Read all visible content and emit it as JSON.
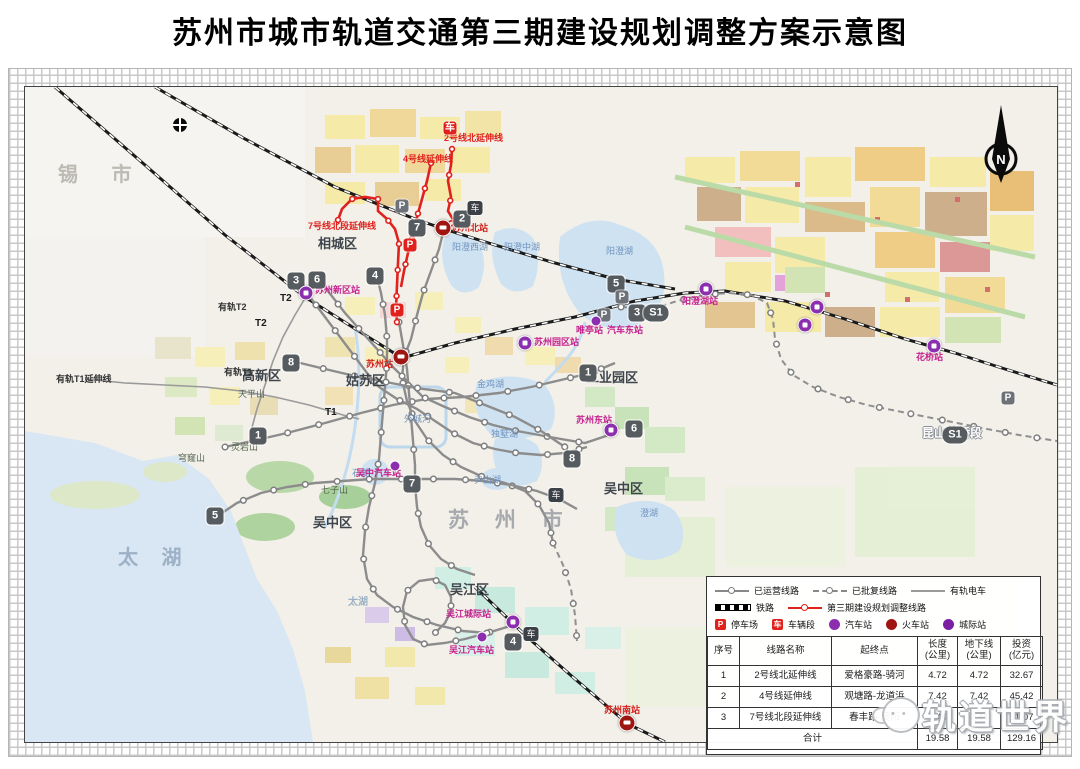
{
  "title": "苏州市城市轨道交通第三期建设规划调整方案示意图",
  "compass": {
    "n": "N"
  },
  "colors": {
    "planned_line": "#e0211c",
    "metro_line": "#8c8c8c",
    "intercity_station": "#8b2fae",
    "train_station": "#9e1512"
  },
  "icons": {
    "parking": "P",
    "depot_glyph": "车",
    "train_glyph": "车"
  },
  "map": {
    "labels": [
      {
        "t": "锡 市"
      },
      {
        "t": "相城区"
      },
      {
        "t": "姑苏区"
      },
      {
        "t": "高新区"
      },
      {
        "t": "工业园区"
      },
      {
        "t": "吴中区"
      },
      {
        "t": "吴中区"
      },
      {
        "t": "吴江区"
      },
      {
        "t": "苏 州 市"
      },
      {
        "t": "太 湖"
      },
      {
        "t": "太湖"
      },
      {
        "t": "昆山花桥段"
      },
      {
        "t": "阳澄西湖"
      },
      {
        "t": "阳澄中湖"
      },
      {
        "t": "阳澄湖"
      },
      {
        "t": "金鸡湖"
      },
      {
        "t": "独墅湖"
      },
      {
        "t": "澄湖"
      },
      {
        "t": "尹山湖"
      },
      {
        "t": "石湖"
      },
      {
        "t": "外城河"
      },
      {
        "t": "天平山"
      },
      {
        "t": "灵岩山"
      },
      {
        "t": "七子山"
      },
      {
        "t": "穹窿山"
      },
      {
        "t": "有轨T1"
      },
      {
        "t": "有轨T1延伸线"
      },
      {
        "t": "有轨T2"
      },
      {
        "t": "T2"
      },
      {
        "t": "T2"
      },
      {
        "t": "T1"
      },
      {
        "t": "2号线北延伸线"
      },
      {
        "t": "4号线延伸线"
      },
      {
        "t": "7号线北段延伸线"
      },
      {
        "t": "苏州北站"
      },
      {
        "t": "苏州站"
      },
      {
        "t": "苏州南站"
      },
      {
        "t": "苏州新区站"
      },
      {
        "t": "苏州园区站"
      },
      {
        "t": "吴江城际站"
      },
      {
        "t": "苏州东站"
      },
      {
        "t": "阳澄湖站"
      },
      {
        "t": "花桥站"
      },
      {
        "t": "汽车东站"
      },
      {
        "t": "吴江汽车站"
      },
      {
        "t": "吴中汽车站"
      },
      {
        "t": "唯亭站"
      }
    ],
    "badges": [
      {
        "t": "2"
      },
      {
        "t": "7"
      },
      {
        "t": "4"
      },
      {
        "t": "3"
      },
      {
        "t": "6"
      },
      {
        "t": "8"
      },
      {
        "t": "1"
      },
      {
        "t": "5"
      },
      {
        "t": "5"
      },
      {
        "t": "1"
      },
      {
        "t": "3"
      },
      {
        "t": "S1"
      },
      {
        "t": "6"
      },
      {
        "t": "8"
      },
      {
        "t": "7"
      },
      {
        "t": "4"
      },
      {
        "t": "S1"
      }
    ]
  },
  "legend": {
    "line_items": [
      {
        "label": "已运营线路"
      },
      {
        "label": "已批复线路"
      },
      {
        "label": "有轨电车"
      },
      {
        "label": "铁路"
      },
      {
        "label": "第三期建设规划调整线路"
      }
    ],
    "icon_items": [
      {
        "label": "停车场"
      },
      {
        "label": "车辆段"
      },
      {
        "label": "汽车站"
      },
      {
        "label": "火车站"
      },
      {
        "label": "城际站"
      }
    ]
  },
  "table": {
    "headers": [
      {
        "a": "序号",
        "b": ""
      },
      {
        "a": "线路名称",
        "b": ""
      },
      {
        "a": "起终点",
        "b": ""
      },
      {
        "a": "长度",
        "b": "(公里)"
      },
      {
        "a": "地下线",
        "b": "(公里)"
      },
      {
        "a": "投资",
        "b": "(亿元)"
      }
    ],
    "rows": [
      [
        "1",
        "2号线北延伸线",
        "爱格豪路-骑河",
        "4.72",
        "4.72",
        "32.67"
      ],
      [
        "2",
        "4号线延伸线",
        "观塘路-龙道浜",
        "7.42",
        "7.42",
        "45.42"
      ],
      [
        "3",
        "7号线北段延伸线",
        "春丰路-莫阳",
        "7.44",
        "7.44",
        "51.07"
      ]
    ],
    "total_label": "合计",
    "totals": [
      "19.58",
      "19.58",
      "129.16"
    ]
  },
  "watermark": {
    "text": "轨道世界"
  }
}
